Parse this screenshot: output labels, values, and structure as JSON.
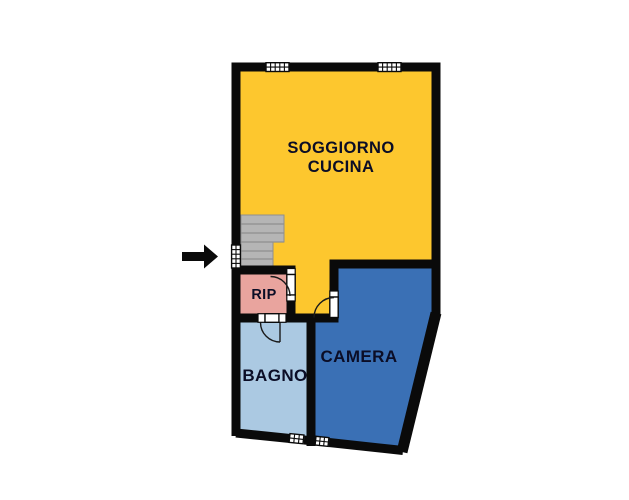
{
  "plan": {
    "kind": "apartment-floor-plan",
    "rooms": {
      "soggiorno_cucina": {
        "line1": "SOGGIORNO",
        "line2": "CUCINA",
        "color": "#fdc72e"
      },
      "rip": {
        "label": "RIP",
        "color": "#e9a49e"
      },
      "bagno": {
        "label": "BAGNO",
        "color": "#abc9e2"
      },
      "camera": {
        "label": "CAMERA",
        "color": "#3a70b5"
      }
    },
    "features": {
      "entrance_arrow_icon": "entrance-arrow-icon",
      "stairs_icon": "stairs-icon",
      "top_windows": 2,
      "bottom_windows": 2,
      "interior_doors": 3,
      "entrance_doors": 1
    },
    "colors": {
      "wall": "#0a0a0a",
      "stairs_fill": "#b5b5b5",
      "door_window_fill": "#ffffff",
      "label_text": "#0b0d26",
      "arrow": "#0a0a0a",
      "background": "#ffffff"
    }
  }
}
